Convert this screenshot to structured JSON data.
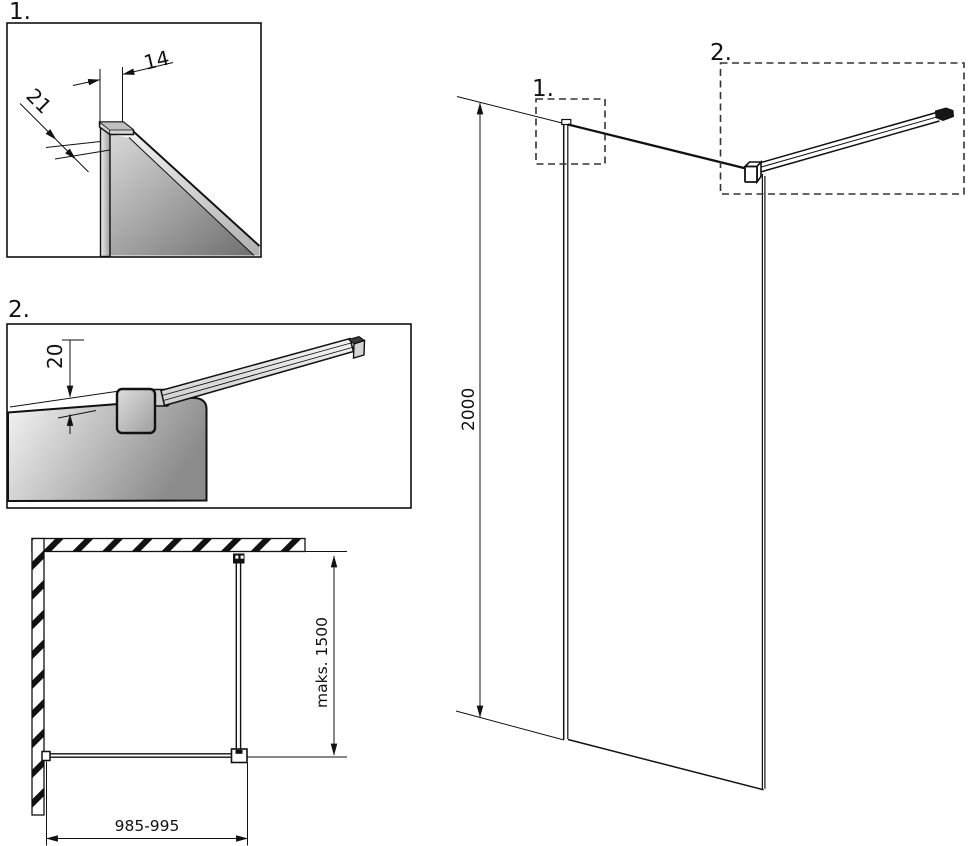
{
  "details": {
    "detail_1": {
      "label": "1.",
      "dim_profile_width": "14",
      "dim_profile_depth": "21"
    },
    "detail_2": {
      "label": "2.",
      "dim_bar_offset": "20"
    }
  },
  "elevation": {
    "marker_1": "1.",
    "marker_2": "2.",
    "dim_height": "2000"
  },
  "plan": {
    "dim_depth": "maks. 1500",
    "dim_width": "985-995"
  },
  "colors": {
    "line": "#111111",
    "background": "#ffffff",
    "glass_light": "#f2f2f2",
    "glass_dark": "#6f6f6f",
    "metal_light": "#ececec",
    "metal_dark": "#9f9f9f",
    "bracket_dark": "#161616",
    "dash_box": "#333333"
  }
}
